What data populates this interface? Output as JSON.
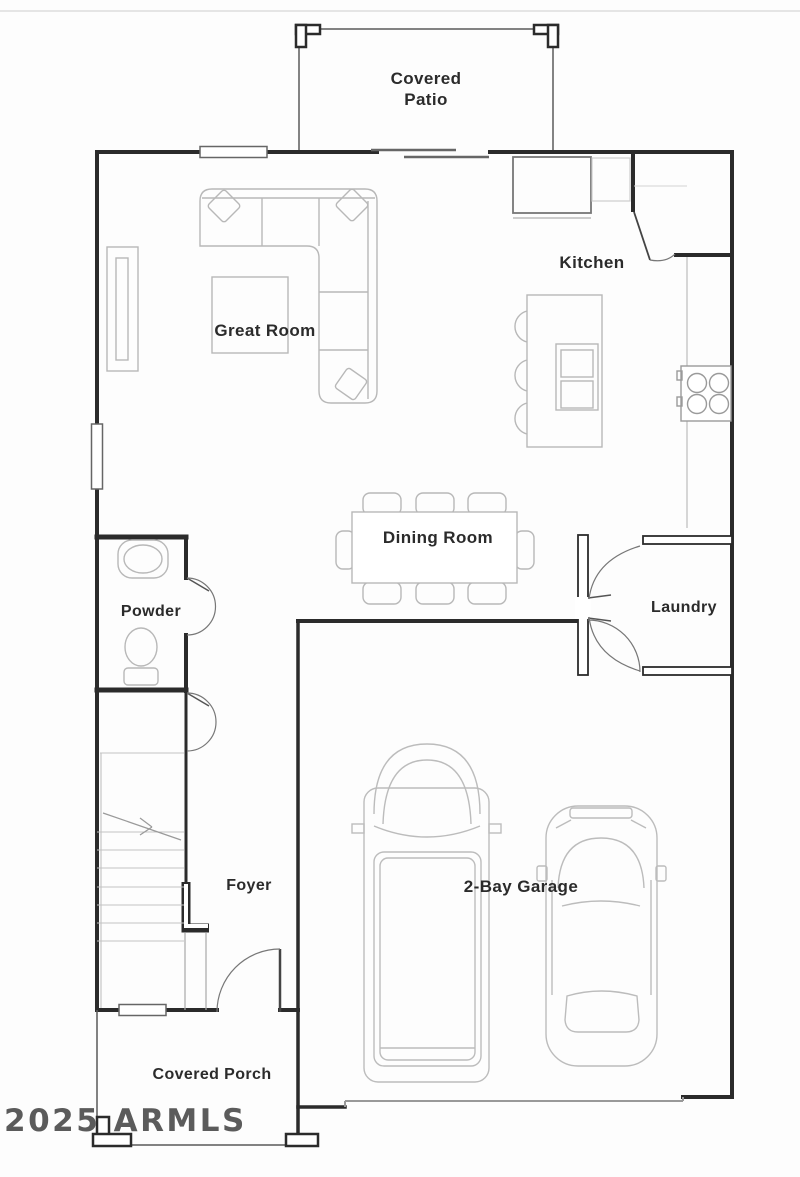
{
  "plan": {
    "labels": {
      "covered_patio_line1": "Covered",
      "covered_patio_line2": "Patio",
      "kitchen": "Kitchen",
      "great_room": "Great Room",
      "dining_room": "Dining Room",
      "powder": "Powder",
      "laundry": "Laundry",
      "foyer": "Foyer",
      "garage": "2-Bay Garage",
      "covered_porch": "Covered Porch"
    },
    "watermark": "2025 ARMLS",
    "colors": {
      "wall": "#2b2b2b",
      "door": "#555555",
      "furniture": "#b8b8b8",
      "label_text": "#2b2b2b",
      "watermark": "#3f3f3f",
      "background": "#ffffff"
    }
  }
}
